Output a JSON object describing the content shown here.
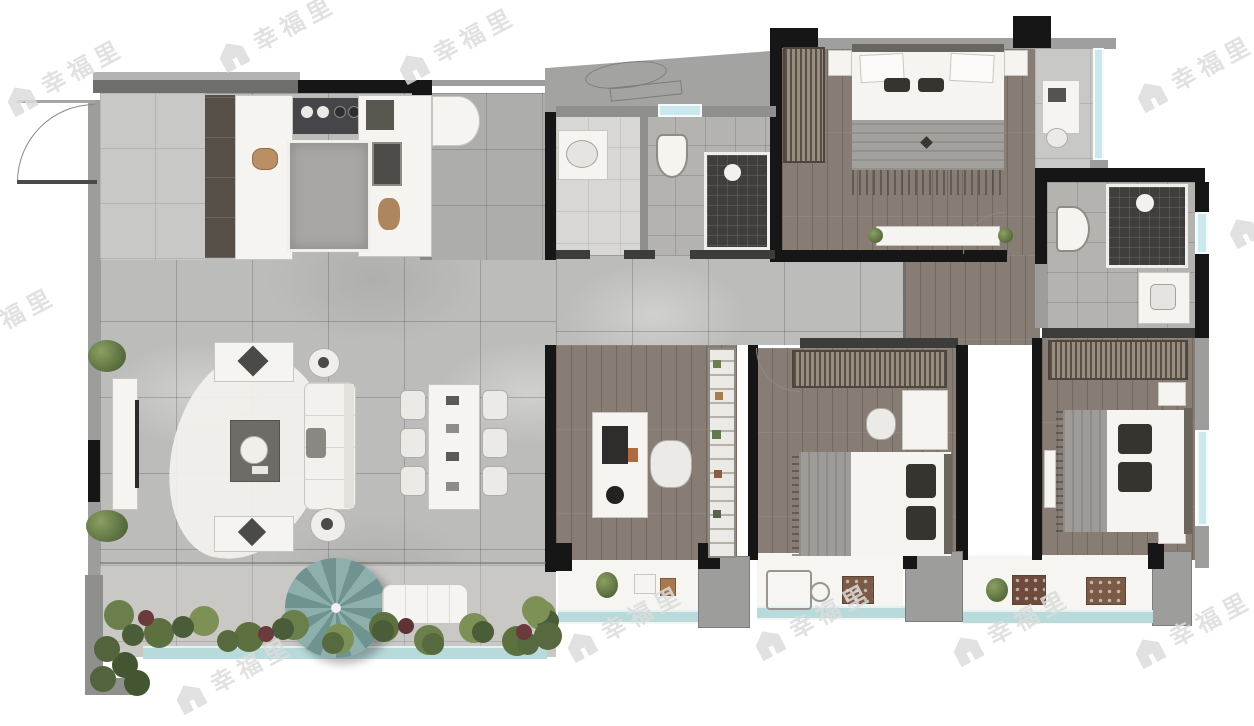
{
  "watermark": {
    "text": "幸福里",
    "icon": "house-icon"
  },
  "palette": {
    "wall_black": "#161616",
    "wall_gray": "#9d9d9b",
    "marble_floor": "#bcbcba",
    "wood_floor": "#877d74",
    "window_teal": "#cbe9ec",
    "railing_teal": "#b9dadb",
    "balcony_white": "#f6f5f2",
    "shrub_green": "#5c7040",
    "umbrella_teal": "#7f9f9c",
    "watermark_gray": "#dcdcdc"
  }
}
